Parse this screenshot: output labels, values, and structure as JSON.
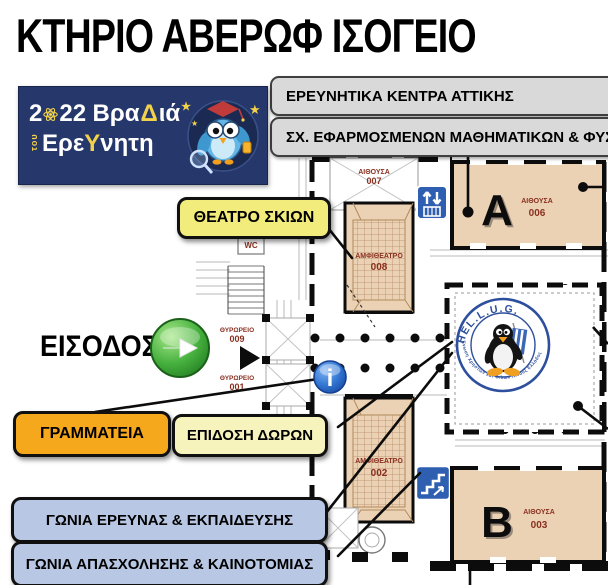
{
  "title": "ΚΤΗΡΙΟ ΑΒΕΡΩΦ ΙΣΟΓΕΙΟ",
  "banner": {
    "year_a": "2",
    "year_b": "22",
    "word1_a": "Βρα",
    "word1_delta": "Δ",
    "word1_b": "ιά",
    "star": "★",
    "tou": "του",
    "word2_a": "Ερε",
    "word2_upsilon": "Υ",
    "word2_b": "νητη"
  },
  "callouts": {
    "research_centers": "ΕΡΕΥΝΗΤΙΚΑ ΚΕΝΤΡΑ ΑΤΤΙΚΗΣ",
    "school": "ΣΧ. ΕΦΑΡΜΟΣΜΕΝΩΝ ΜΑΘΗΜΑΤΙΚΩΝ & ΦΥΣΙ",
    "shadow_theater": "ΘΕΑΤΡΟ ΣΚΙΩΝ",
    "entrance": "ΕΙΣΟΔΟΣ",
    "secretariat": "ΓΡΑΜΜΑΤΕΙΑ",
    "gift_delivery": "ΕΠΙΔΟΣΗ ΔΩΡΩΝ",
    "research_corner": "ΓΩΝΙΑ ΕΡΕΥΝΑΣ & ΕΚΠΑΙΔΕΥΣΗΣ",
    "employment_corner": "ΓΩΝΙΑ ΑΠΑΣΧΟΛΗΣΗΣ & ΚΑΙΝΟΤΟΜΙΑΣ"
  },
  "plan": {
    "room_a_letter": "A",
    "room_a_label": "ΑΙΘΟΥΣΑ",
    "room_a_number": "006",
    "room_b_letter": "B",
    "room_b_label": "ΑΙΘΟΥΣΑ",
    "room_b_number": "003",
    "room_007_label": "ΑΙΘΟΥΣΑ",
    "room_007_number": "007",
    "amph_008_label": "ΑΜΦΙΘΕΑΤΡΟ",
    "amph_008_number": "008",
    "amph_002_label": "ΑΜΦΙΘΕΑΤΡΟ",
    "amph_002_number": "002",
    "porter_009_label": "ΘΥΡΩΡΕΙΟ",
    "porter_009_number": "009",
    "porter_001_label": "ΘΥΡΩΡΕΙΟ",
    "porter_001_number": "001",
    "wc_label": "WC",
    "info_glyph": "i"
  },
  "hellug": {
    "name": "HEL.L.U.G.",
    "arc_text": "Ένωση Χρηστών και Φίλων Λίνουξ Ελλάδος"
  },
  "colors": {
    "banner_navy": "#25376b",
    "banner_yellow": "#f2d24b",
    "note_grey": "#d9d9d9",
    "theater_yellow": "#f2ec7c",
    "gift_pale_yellow": "#f7f3bc",
    "secretariat_orange": "#f6a81c",
    "corner_blue": "#b8c7e4",
    "room_tan": "#ecd2b4",
    "room_text_red": "#8a3020",
    "icon_blue": "#2f5fb0",
    "info_blue": "#2f74d0",
    "entrance_green": "#3aa33a"
  }
}
